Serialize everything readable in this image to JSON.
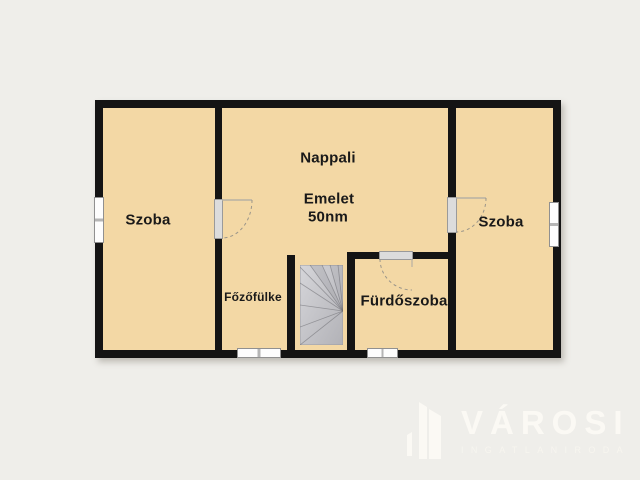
{
  "plan": {
    "room_left": "Szoba",
    "living_room": "Nappali",
    "floor_label": "Emelet",
    "area_label": "50nm",
    "room_right": "Szoba",
    "kitchenette": "Főzőfülke",
    "bathroom": "Fürdőszoba"
  },
  "colors": {
    "background": "#efeeea",
    "room_fill": "#f3d8a5",
    "wall": "#141414",
    "stairs": "#c3c3c7",
    "watermark": "#fbf9f4"
  },
  "watermark": {
    "brand": "VÁROSI",
    "tagline": "INGATLANIRODA"
  }
}
